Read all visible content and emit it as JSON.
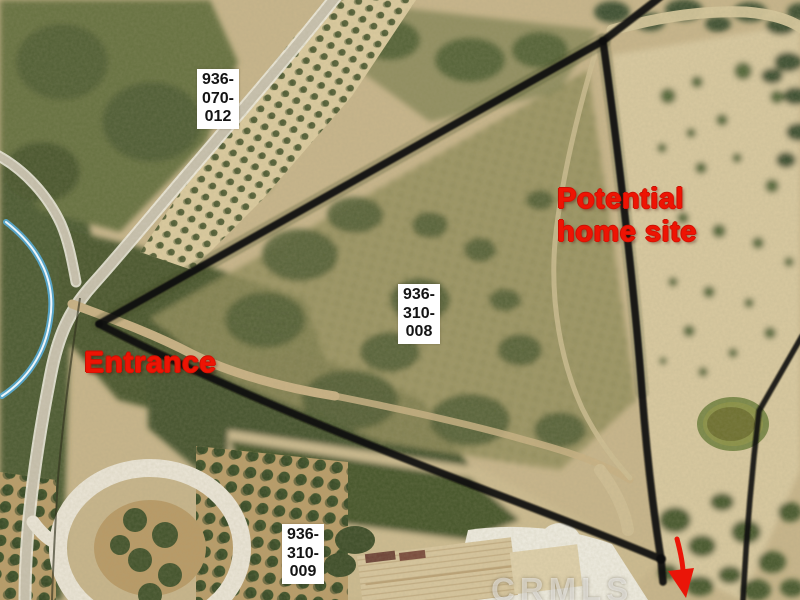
{
  "map": {
    "watermark": "CRMLS",
    "annotations": {
      "entrance": "Entrance",
      "home_site": "Potential\nhome site"
    },
    "parcels": [
      {
        "apn": "936-070-012",
        "display": "936-\n070-\n012"
      },
      {
        "apn": "936-310-008",
        "display": "936-\n310-\n008"
      },
      {
        "apn": "936-310-009",
        "display": "936-\n310-\n009"
      }
    ],
    "colors": {
      "annotation_red": "#ee1404",
      "boundary_line": "#0e0e08",
      "parcel_label_bg": "#ffffff",
      "parcel_label_text": "#141414",
      "terrain_tan": "#c8b58b",
      "scrub_green": "#4c5a33",
      "pond_water": "#6e7030",
      "road_light": "#ece6d8",
      "creek_blue": "#59b5e8",
      "watermark_white": "rgba(255,255,255,0.5)"
    }
  }
}
